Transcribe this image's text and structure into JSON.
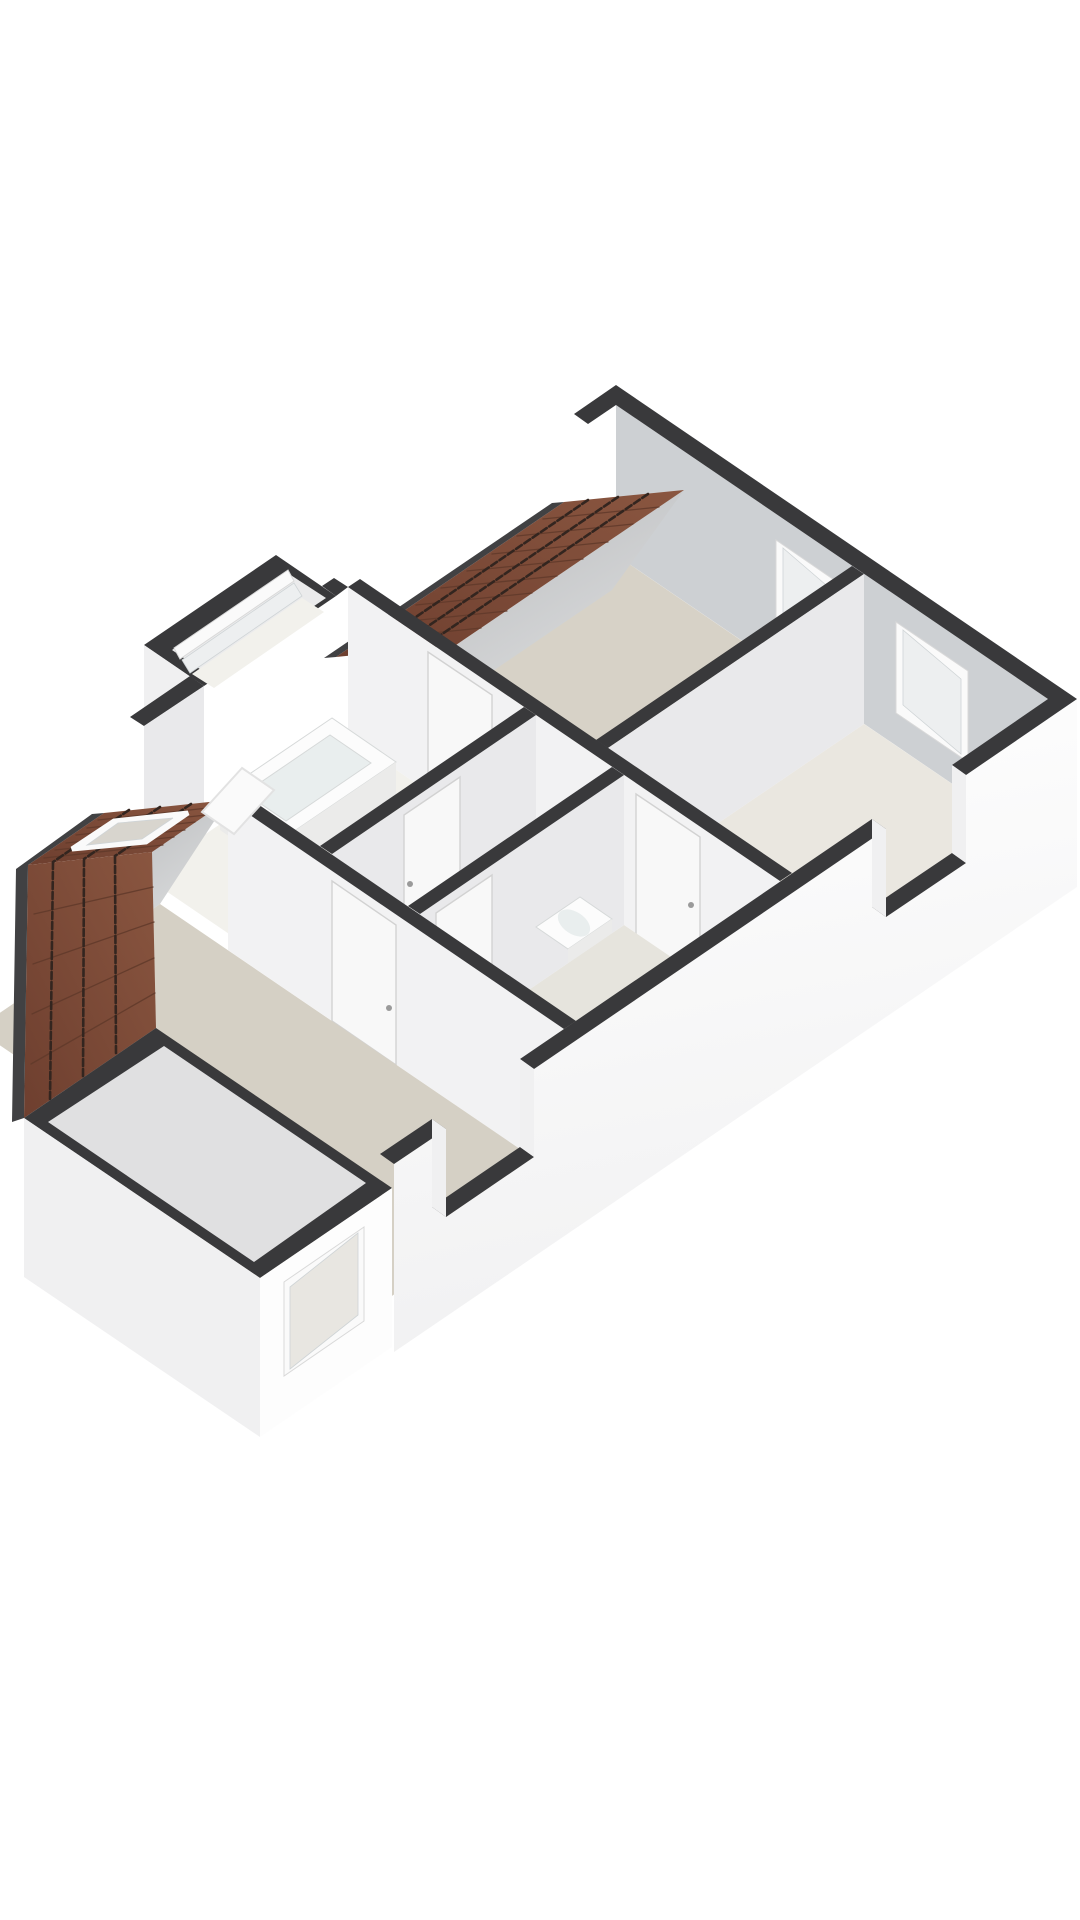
{
  "colors": {
    "background": "#ffffff",
    "wallTop": "#39393b",
    "wallOuter": "#fdfdfd",
    "wallOuterShade": "#f0f0f1",
    "wallLit": "#f2f2f3",
    "wallMid": "#e9e9eb",
    "wallShade": "#cdd0d3",
    "knee1": "#b5b7b9",
    "knee2": "#e0e1e2",
    "floorBedroomA": "#d7d2c7",
    "floorBedroomB": "#eae7e0",
    "floorBath": "#f2f1ec",
    "floorHall": "#dbd9d1",
    "floorWash": "#e6e4dd",
    "floorBig": "#d5d0c5",
    "roofLight": "#8a5640",
    "roofDark": "#6e3f2f",
    "roofBatten": "#33251f",
    "roofRib": "#60392a",
    "eave": "#414143",
    "frame": "#fafafa",
    "glass": "#edeff0",
    "glassWarm": "#e8e6e1",
    "skylightGlass": "#d8d5ce",
    "bayInterior": "#ebebec",
    "boxInterior": "#e0e0e1",
    "doorFill": "#f8f8f8",
    "handle": "#9a9a9a",
    "fixture": "#fcfcfc",
    "fixtureShade": "#ebebea",
    "basin": "#e9eeee"
  },
  "scene": {
    "type": "floorplan-3d",
    "projection": "axonometric",
    "features": [
      "bedroom-a",
      "bedroom-b",
      "bathroom",
      "hallway",
      "washroom",
      "attic-room",
      "window-bay",
      "sw-dormer",
      "ne-roof-slope",
      "sw-roof-slope",
      "roof-skylight",
      "open-roof-window-pane",
      "end-wall-window-1",
      "end-wall-window-2",
      "bay-window",
      "dormer-window",
      "facade-opening-1",
      "facade-opening-2"
    ],
    "fixtures": [
      "bathtub",
      "washbasin",
      "toilet"
    ],
    "window_counts": {
      "end_wall": 2,
      "bay": 1,
      "dormer": 1,
      "skylight": 1,
      "facade_openings": 2
    }
  }
}
